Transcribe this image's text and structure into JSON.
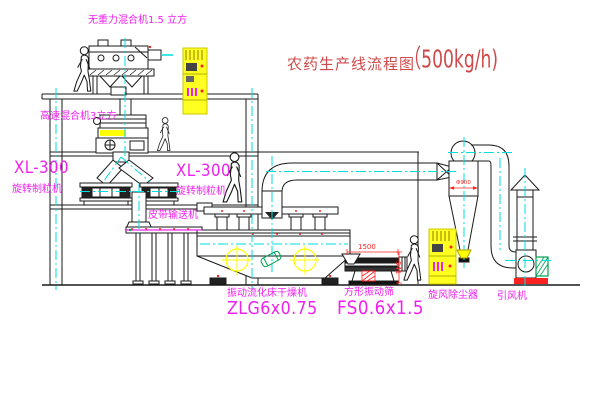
{
  "title": {
    "text": "农药生产线流程图",
    "capacity": "（500kg/h)"
  },
  "equipment_labels": {
    "zero_gravity_mixer": "无重力混合机1.5 立方",
    "high_speed_mixer": "高速混合机3立方",
    "granulator_left_model": "XL-300",
    "granulator_left_name": "旋转制粒机",
    "granulator_right_model": "XL-300",
    "granulator_right_name": "旋转制粒机",
    "belt_conveyor": "皮带输送机",
    "fluid_bed_dryer_name": "振动流化床干燥机",
    "fluid_bed_dryer_model": "ZLG6x0.75",
    "vibrating_screen_name": "方形振动筛",
    "vibrating_screen_model": "FS0.6x1.5",
    "cyclone": "旋风除尘器",
    "induced_draft_fan": "引风机"
  },
  "dimensions": {
    "screen_length": "1500",
    "screen_height": "541",
    "cyclone_diameter": "Φ900"
  },
  "colors": {
    "label_magenta": "#ee22ee",
    "title_red": "#cf4a4a",
    "dimension_red": "#ff2222",
    "centerline_cyan": "#00dddd",
    "cabinet_yellow": "#ffff00",
    "motor_green": "#00a050",
    "line_black": "#1a1a1a",
    "background": "#ffffff"
  }
}
